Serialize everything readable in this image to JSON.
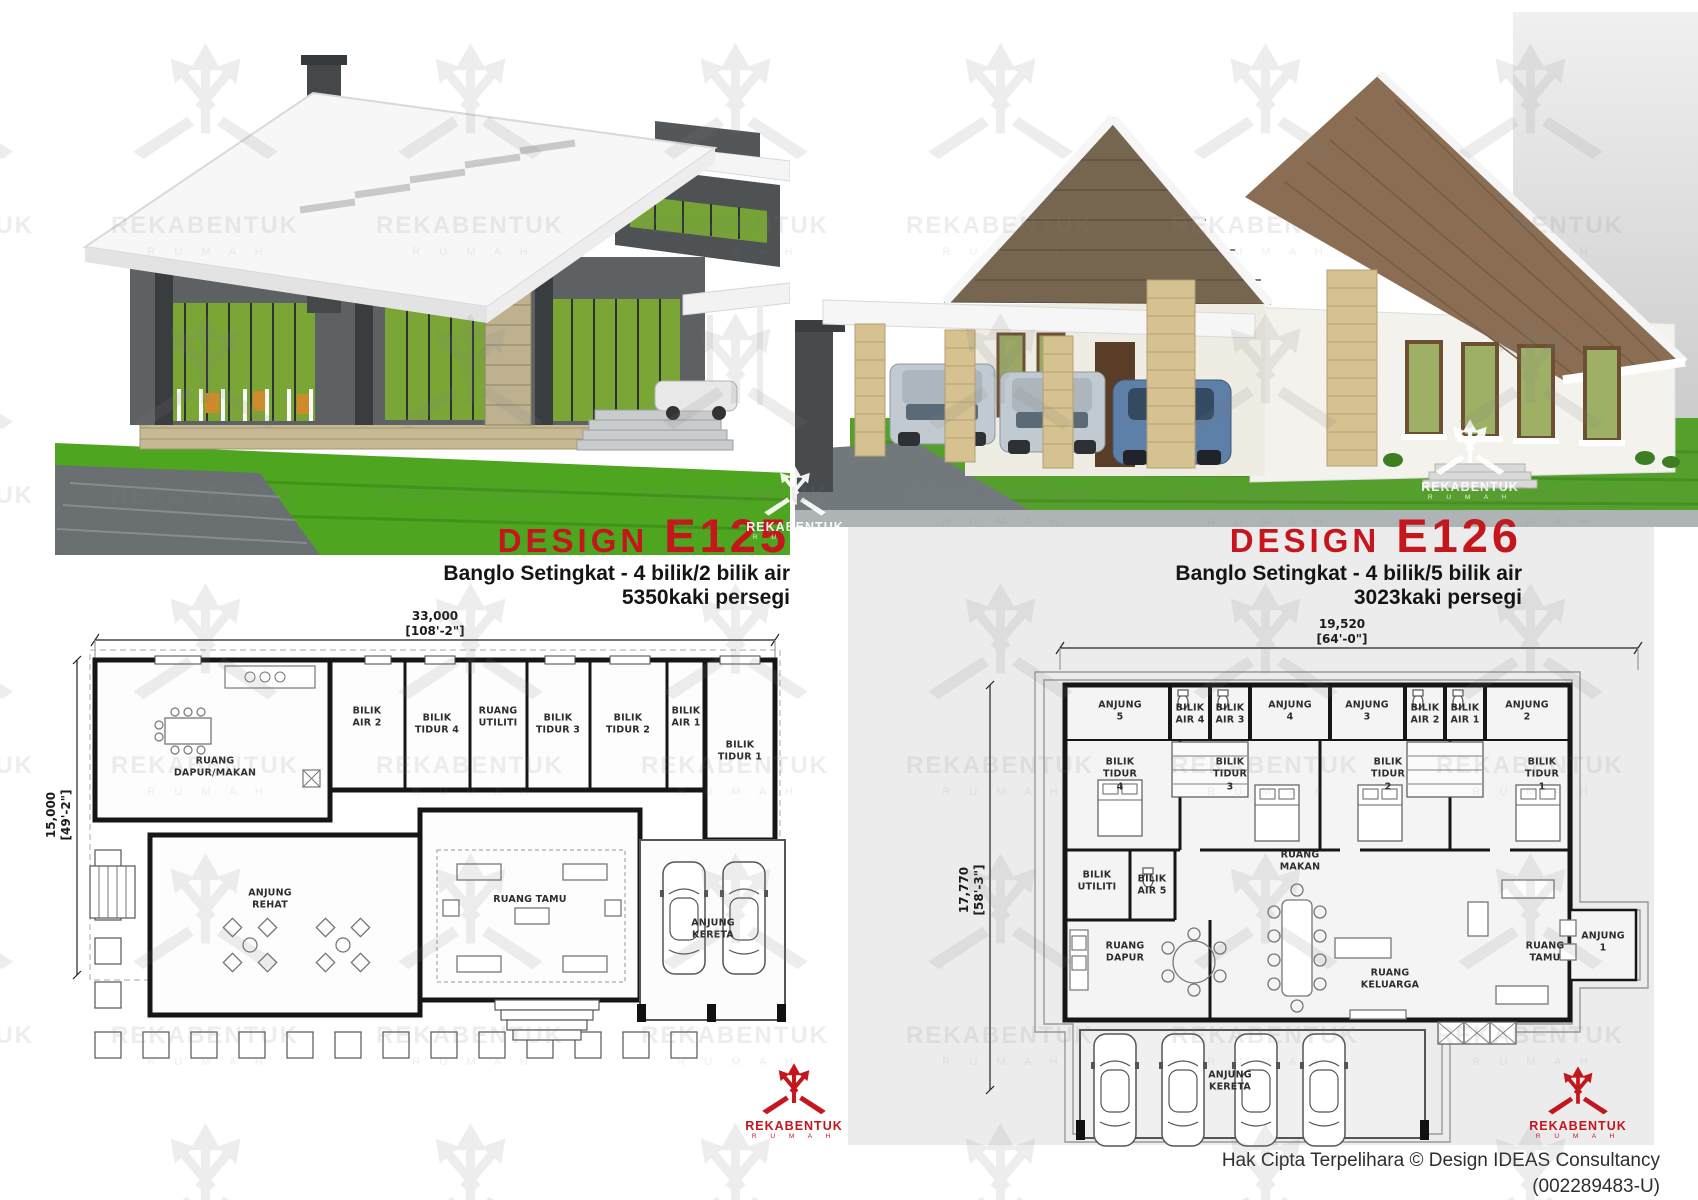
{
  "brand": {
    "name": "REKABENTUK",
    "sub": "R U M A H",
    "red": "#c4161c"
  },
  "designs": [
    {
      "label": "DESIGN",
      "code": "E125",
      "desc": "Banglo Setingkat - 4 bilik/2 bilik air",
      "area": "5350kaki persegi",
      "dims": {
        "top": "33,000\n[108'-2\"]",
        "left": "15,000\n[49'-2\"]"
      },
      "rooms": [
        "RUANG\nDAPUR/MAKAN",
        "BILIK\nAIR 2",
        "BILIK\nTIDUR 4",
        "RUANG\nUTILITI",
        "BILIK\nTIDUR 3",
        "BILIK\nTIDUR 2",
        "BILIK\nAIR 1",
        "BILIK TIDUR 1",
        "ANJUNG\nREHAT",
        "RUANG TAMU",
        "ANJUNG\nKERETA"
      ]
    },
    {
      "label": "DESIGN",
      "code": "E126",
      "desc": "Banglo Setingkat - 4 bilik/5 bilik air",
      "area": "3023kaki persegi",
      "dims": {
        "top": "19,520\n[64'-0\"]",
        "left": "17,770\n[58'-3\"]"
      },
      "rooms": [
        "ANJUNG\n5",
        "BILIK\nAIR 4",
        "BILIK\nAIR 3",
        "ANJUNG\n4",
        "ANJUNG\n3",
        "BILIK\nAIR 2",
        "BILIK\nAIR 1",
        "ANJUNG\n2",
        "BILIK\nTIDUR\n4",
        "BILIK\nTIDUR\n3",
        "BILIK\nTIDUR\n2",
        "BILIK\nTIDUR\n1",
        "BILIK\nUTILITI",
        "BILIK\nAIR 5",
        "RUANG\nMAKAN",
        "RUANG\nDAPUR",
        "RUANG\nKELUARGA",
        "RUANG\nTAMU",
        "ANJUNG\n1",
        "ANJUNG\nKERETA"
      ]
    }
  ],
  "footer": {
    "line1": "Hak Cipta Terpelihara © Design IDEAS Consultancy",
    "line2": "(002289483-U)"
  }
}
